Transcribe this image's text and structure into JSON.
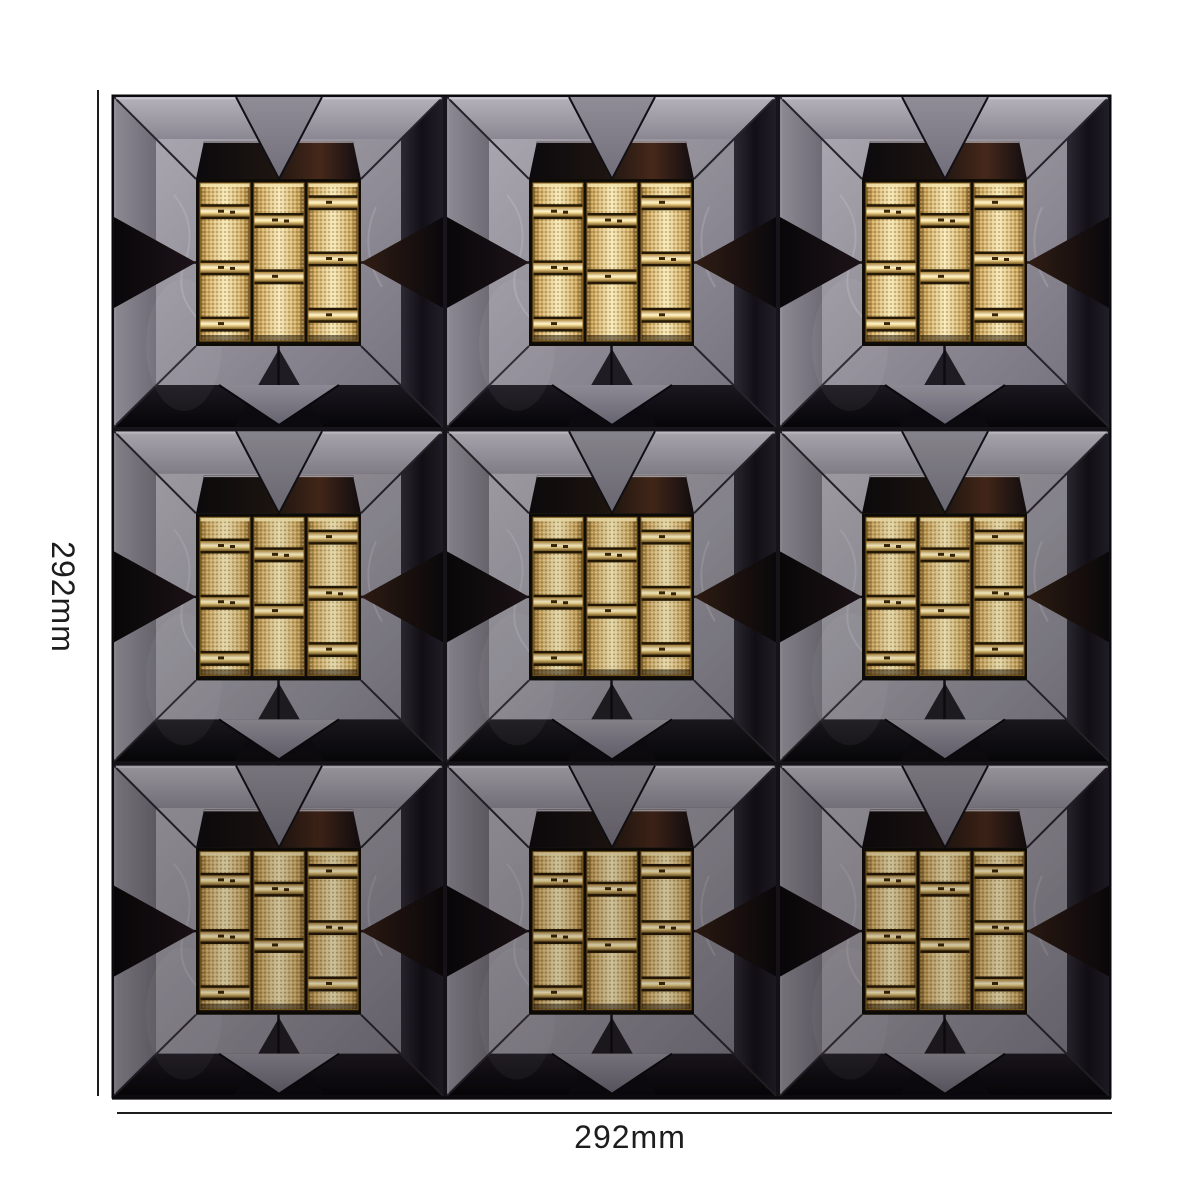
{
  "figure": {
    "type": "product-photo",
    "subject": "3D beveled glass-metal mosaic wall tile sheet",
    "description": "Square mosaic sheet of glossy gun-metal beveled chips arranged in a 3x3 frame pattern; each module frames a square knurled gold inlay made of three ribbed cylindrical columns with bright ring bands",
    "grid": {
      "rows": 3,
      "cols": 3
    },
    "gold_insert": {
      "columns": 3,
      "segments_per_column": 3
    },
    "colors": {
      "background": "#ffffff",
      "frame_gray": "#908d97",
      "bevel_light": "#b2afb9",
      "bevel_dark": "#16131b",
      "bevel_black": "#0a090d",
      "warm_reflection": "#46281a",
      "grout": "#17151b",
      "gold_base": "#d8b166",
      "gold_highlight": "#f7e9b8",
      "gold_band": "#fff4cd",
      "gold_shadow": "#7d5c24",
      "dimension_line": "#1d1d1d"
    }
  },
  "dimensions": {
    "height_label": "292mm",
    "width_label": "292mm"
  }
}
